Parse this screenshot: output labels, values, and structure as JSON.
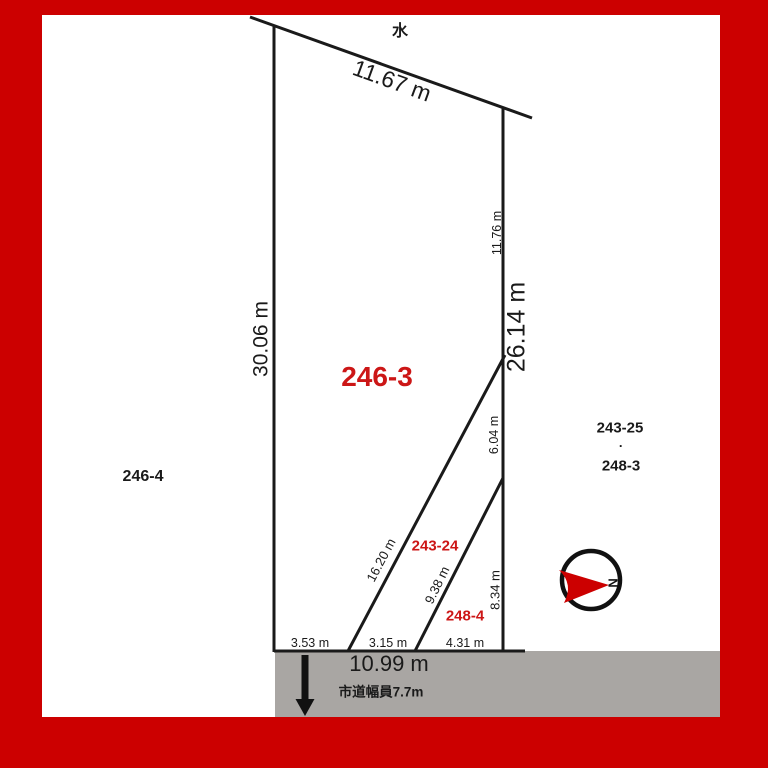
{
  "colors": {
    "frame_red": "#cc0000",
    "parcel_label_red": "#cc1616",
    "road_gray": "#a9a6a3",
    "line_black": "#1a1a1a"
  },
  "compass": {
    "north_label": "N"
  },
  "boundary": {
    "water_label": "水",
    "top_edge": "11.67 m",
    "left_edge": "30.06 m",
    "right_edge_total": "26.14 m",
    "right_segment_top": "11.76 m",
    "right_segment_middle": "6.04 m",
    "right_segment_bottom": "8.34 m",
    "inner_diagonal_long": "16.20 m",
    "inner_diagonal_short": "9.38 m",
    "bottom_segment_left": "3.53 m",
    "bottom_segment_middle": "3.15 m",
    "bottom_segment_right": "4.31 m"
  },
  "road": {
    "total_width_label": "10.99 m",
    "name_label": "市道幅員7.7m"
  },
  "parcels": {
    "main": "246-3",
    "west": "246-4",
    "east_upper": "243-25",
    "east_separator": "·",
    "east_lower": "248-3",
    "inner_upper": "243-24",
    "inner_lower": "248-4"
  }
}
